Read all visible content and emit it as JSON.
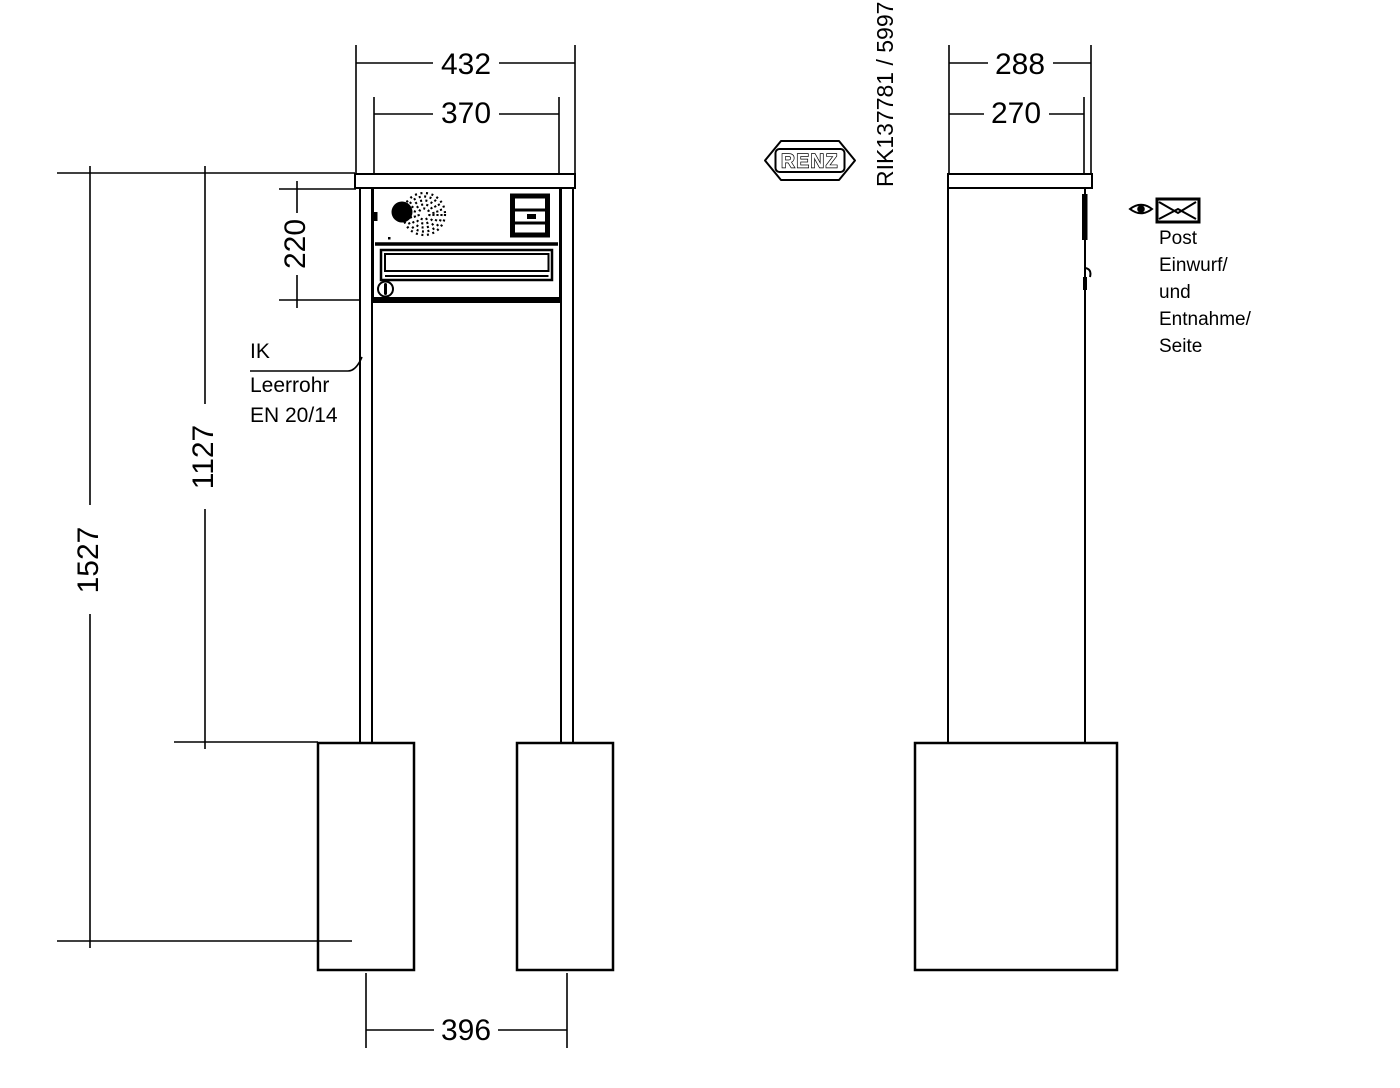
{
  "page": {
    "background": "#ffffff",
    "line_color": "#000000"
  },
  "brand": {
    "logo": "RENZ",
    "part_number": "RIK137781 / 5997"
  },
  "front_view": {
    "dimensions": {
      "plate_width": "432",
      "box_width": "370",
      "box_height": "220",
      "post_height": "1127",
      "total_height": "1527",
      "post_spacing": "396"
    },
    "conduit_note": [
      "IK",
      "Leerrohr",
      "EN 20/14"
    ]
  },
  "side_view": {
    "dimensions": {
      "plate_depth": "288",
      "box_depth": "270"
    },
    "mail_note": [
      "Post",
      "Einwurf/",
      "und",
      "Entnahme/",
      "Seite"
    ]
  },
  "icons": {
    "view_direction": "eye-icon",
    "mail": "envelope-icon",
    "speaker": "speaker-grille-icon",
    "bell_panel": "bell-panel-icon",
    "lock": "keyhole-icon"
  }
}
